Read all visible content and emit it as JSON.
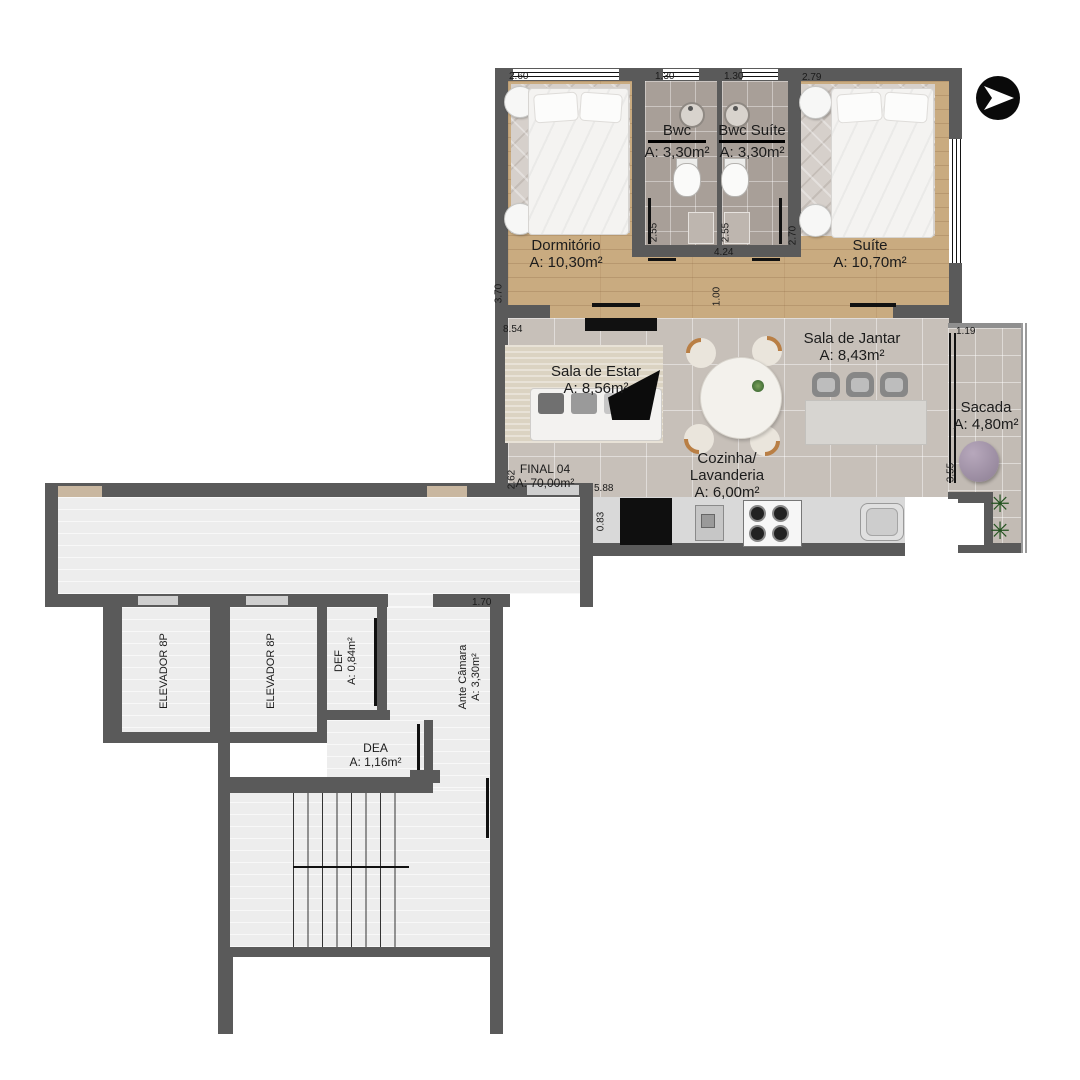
{
  "unit": {
    "name": "FINAL 04",
    "area": "A: 70,00m²"
  },
  "rooms": {
    "dormitorio": {
      "name": "Dormitório",
      "area": "A: 10,30m²"
    },
    "bwc": {
      "name": "Bwc",
      "area": "A: 3,30m²"
    },
    "bwc_suite": {
      "name": "Bwc Suíte",
      "area": "A: 3,30m²"
    },
    "suite": {
      "name": "Suíte",
      "area": "A: 10,70m²"
    },
    "sala_estar": {
      "name": "Sala de Estar",
      "area": "A: 8,56m²"
    },
    "sala_jantar": {
      "name": "Sala de Jantar",
      "area": "A: 8,43m²"
    },
    "cozinha": {
      "line1": "Cozinha/",
      "line2": "Lavanderia",
      "area": "A: 6,00m²"
    },
    "sacada": {
      "name": "Sacada",
      "area": "A: 4,80m²"
    },
    "elevador1": {
      "name": "ELEVADOR 8P"
    },
    "elevador2": {
      "name": "ELEVADOR 8P"
    },
    "def": {
      "name": "DEF",
      "area": "A: 0,84m²"
    },
    "ante_camara": {
      "name": "Ante Câmara",
      "area": "A: 3,30m²"
    },
    "dea": {
      "name": "DEA",
      "area": "A: 1,16m²"
    }
  },
  "dims": {
    "dorm_w": "2.60",
    "bwc_w": "1.30",
    "bwcs_w": "1.30",
    "suite_w": "2.79",
    "dorm_h": "3.70",
    "bwc_h": "2.55",
    "bwcs_h": "2.55",
    "suite_h": "2.70",
    "bath_w": "4.24",
    "hall_h": "1.00",
    "living_w": "8.54",
    "sacada_w": "1.19",
    "final_h": "2.62",
    "kitchen_w": "5.88",
    "kitchen_h": "0.83",
    "sacada_h": "3.55",
    "ante_w": "1.70"
  },
  "icons": {
    "north_arrow": "north-arrow",
    "plant_glyph": "✳"
  },
  "colors": {
    "wall": "#5a5a5a",
    "wood": "#c9ab80",
    "bath_tile": "#a89f98",
    "living_tile": "#c7c0b9",
    "pouf": "#8d7f94",
    "arrow_bg": "#0a0a0a"
  }
}
